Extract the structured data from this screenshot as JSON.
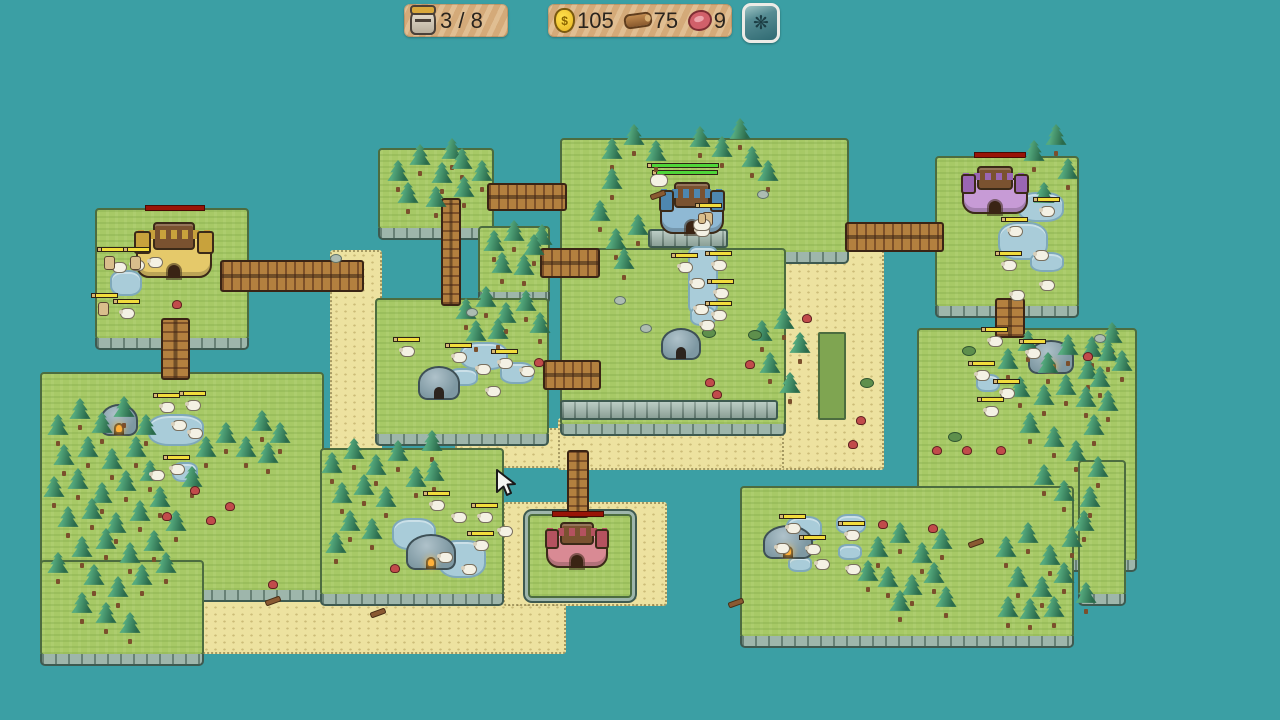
{
  "hud": {
    "units": {
      "icon": "helmet-icon",
      "value": "3 / 8"
    },
    "resources": [
      {
        "icon": "gold-bag-icon",
        "value": "105"
      },
      {
        "icon": "wood-log-icon",
        "value": "75"
      },
      {
        "icon": "meat-icon",
        "value": "9"
      }
    ],
    "settings": {
      "icon": "gear-icon",
      "glyph": "❋"
    }
  },
  "palette": {
    "sea": "#3B9FA4",
    "grass": "#A7C966",
    "sand": "#EDE2A0",
    "water": "#A9CCD9",
    "stone": "#9EB6AB",
    "wood": "#B3803F",
    "tree": "#2B6B4C",
    "health_yellow": "#F2DC3C",
    "health_green": "#4ED639",
    "spawn_red": "#991407",
    "hud_panel": "#D4AA79"
  },
  "cursor": {
    "x": 494,
    "y": 468
  },
  "map": {
    "sands": [
      [
        330,
        250,
        48,
        212
      ],
      [
        200,
        588,
        362,
        62
      ],
      [
        455,
        428,
        208,
        36
      ],
      [
        503,
        502,
        160,
        100
      ],
      [
        775,
        238,
        105,
        228
      ],
      [
        558,
        418,
        222,
        48
      ],
      [
        740,
        588,
        96,
        46
      ]
    ],
    "plots": [
      [
        818,
        332,
        24,
        84
      ]
    ],
    "islands": [
      {
        "n": "top-left-castle-island",
        "r": [
          95,
          208,
          150,
          128
        ]
      },
      {
        "n": "top-tree-island",
        "r": [
          378,
          148,
          112,
          78
        ]
      },
      {
        "n": "small-tree-island",
        "r": [
          478,
          226,
          68,
          64
        ]
      },
      {
        "n": "central-island-north",
        "r": [
          560,
          138,
          285,
          112
        ]
      },
      {
        "n": "central-island-south",
        "r": [
          560,
          248,
          222,
          174
        ]
      },
      {
        "n": "hut-island",
        "r": [
          375,
          298,
          170,
          134
        ]
      },
      {
        "n": "top-right-castle-island",
        "r": [
          935,
          156,
          140,
          148
        ]
      },
      {
        "n": "right-island-main",
        "r": [
          917,
          328,
          216,
          230
        ]
      },
      {
        "n": "right-island-east-step",
        "r": [
          1078,
          460,
          44,
          132
        ]
      },
      {
        "n": "right-island-lower",
        "r": [
          740,
          486,
          330,
          148
        ]
      },
      {
        "n": "left-island-upper",
        "r": [
          40,
          372,
          280,
          216
        ]
      },
      {
        "n": "left-island-lower",
        "r": [
          40,
          560,
          160,
          92
        ]
      },
      {
        "n": "bottom-mid-tree-island",
        "r": [
          320,
          448,
          180,
          144
        ]
      },
      {
        "n": "red-castle-patch",
        "r": [
          528,
          514,
          100,
          80
        ],
        "ring": true
      }
    ],
    "walls": [
      [
        560,
        400,
        214,
        16
      ],
      [
        648,
        229,
        76,
        15
      ]
    ],
    "bridges": [
      {
        "n": "bridge-topleft-east",
        "r": [
          220,
          260,
          140,
          28
        ],
        "dir": "h"
      },
      {
        "n": "bridge-topmid-east",
        "r": [
          487,
          183,
          76,
          24
        ],
        "dir": "h"
      },
      {
        "n": "bridge-central-west-upper",
        "r": [
          540,
          248,
          56,
          26
        ],
        "dir": "h"
      },
      {
        "n": "bridge-central-west-lower",
        "r": [
          543,
          360,
          54,
          26
        ],
        "dir": "h"
      },
      {
        "n": "bridge-central-topright",
        "r": [
          845,
          222,
          95,
          26
        ],
        "dir": "h"
      },
      {
        "n": "bridge-topmid-south",
        "r": [
          441,
          198,
          16,
          104
        ],
        "dir": "v"
      },
      {
        "n": "bridge-topleft-south",
        "r": [
          161,
          318,
          25,
          58
        ],
        "dir": "v"
      },
      {
        "n": "bridge-topright-south",
        "r": [
          995,
          298,
          26,
          36
        ],
        "dir": "v"
      },
      {
        "n": "bridge-red-castle-north",
        "r": [
          567,
          450,
          18,
          64
        ],
        "dir": "v"
      }
    ],
    "ponds": [
      [
        110,
        270,
        28,
        22
      ],
      [
        148,
        414,
        52,
        28
      ],
      [
        172,
        462,
        22,
        16
      ],
      [
        392,
        518,
        40,
        28
      ],
      [
        438,
        540,
        44,
        34
      ],
      [
        460,
        342,
        44,
        24
      ],
      [
        500,
        362,
        30,
        18
      ],
      [
        448,
        368,
        26,
        14
      ],
      [
        688,
        246,
        26,
        64
      ],
      [
        690,
        306,
        22,
        16
      ],
      [
        1018,
        192,
        42,
        26
      ],
      [
        998,
        222,
        46,
        34
      ],
      [
        1030,
        252,
        30,
        16
      ],
      [
        1034,
        342,
        34,
        20
      ],
      [
        976,
        374,
        20,
        14
      ],
      [
        786,
        516,
        32,
        22
      ],
      [
        836,
        514,
        26,
        16
      ],
      [
        838,
        544,
        20,
        12
      ],
      [
        788,
        556,
        20,
        12
      ]
    ],
    "castles": [
      {
        "n": "castle-yellow",
        "r": [
          136,
          222,
          76,
          56
        ],
        "wall": "#E5C96A",
        "accent": "#C8A23C"
      },
      {
        "n": "castle-blue",
        "r": [
          660,
          182,
          64,
          52
        ],
        "wall": "#8FB9D4",
        "accent": "#4E87B0"
      },
      {
        "n": "castle-purple",
        "r": [
          962,
          166,
          66,
          48
        ],
        "wall": "#C79BD6",
        "accent": "#9A66B4"
      },
      {
        "n": "castle-red",
        "r": [
          546,
          522,
          62,
          46
        ],
        "wall": "#D98A94",
        "accent": "#B4525F"
      }
    ],
    "spawn_bars": [
      [
        145,
        205,
        58
      ],
      [
        974,
        152,
        50
      ],
      [
        552,
        511,
        50
      ]
    ],
    "queue_bars": [
      [
        647,
        163,
        72
      ],
      [
        652,
        170,
        66
      ]
    ],
    "huts": [
      {
        "r": [
          418,
          366,
          38,
          30
        ],
        "fire": false
      },
      {
        "r": [
          661,
          328,
          36,
          28
        ],
        "fire": false
      },
      {
        "r": [
          100,
          404,
          34,
          28
        ],
        "fire": true
      },
      {
        "r": [
          406,
          534,
          46,
          32
        ],
        "fire": true
      },
      {
        "r": [
          763,
          525,
          46,
          30
        ],
        "fire": true
      },
      {
        "r": [
          1028,
          340,
          42,
          30
        ],
        "fire": true
      }
    ],
    "trees": [
      [
        398,
        192
      ],
      [
        420,
        176
      ],
      [
        442,
        194
      ],
      [
        462,
        180
      ],
      [
        408,
        214
      ],
      [
        436,
        218
      ],
      [
        464,
        208
      ],
      [
        482,
        192
      ],
      [
        452,
        170
      ],
      [
        494,
        262
      ],
      [
        514,
        252
      ],
      [
        534,
        266
      ],
      [
        502,
        284
      ],
      [
        524,
        286
      ],
      [
        542,
        256
      ],
      [
        612,
        170
      ],
      [
        634,
        156
      ],
      [
        656,
        172
      ],
      [
        612,
        200
      ],
      [
        600,
        232
      ],
      [
        616,
        260
      ],
      [
        638,
        246
      ],
      [
        624,
        280
      ],
      [
        700,
        158
      ],
      [
        722,
        168
      ],
      [
        752,
        178
      ],
      [
        768,
        192
      ],
      [
        740,
        150
      ],
      [
        762,
        352
      ],
      [
        784,
        340
      ],
      [
        800,
        364
      ],
      [
        770,
        384
      ],
      [
        790,
        404
      ],
      [
        466,
        330
      ],
      [
        486,
        318
      ],
      [
        506,
        334
      ],
      [
        526,
        322
      ],
      [
        540,
        344
      ],
      [
        476,
        352
      ],
      [
        498,
        350
      ],
      [
        1034,
        172
      ],
      [
        1056,
        156
      ],
      [
        1068,
        190
      ],
      [
        1044,
        214
      ],
      [
        1008,
        380
      ],
      [
        1028,
        362
      ],
      [
        1048,
        384
      ],
      [
        1068,
        366
      ],
      [
        1088,
        390
      ],
      [
        1108,
        372
      ],
      [
        1020,
        408
      ],
      [
        1044,
        416
      ],
      [
        1066,
        406
      ],
      [
        1092,
        368
      ],
      [
        1112,
        354
      ],
      [
        1122,
        382
      ],
      [
        1100,
        398
      ],
      [
        1086,
        418
      ],
      [
        1108,
        422
      ],
      [
        1094,
        446
      ],
      [
        1030,
        444
      ],
      [
        1054,
        458
      ],
      [
        1076,
        472
      ],
      [
        1098,
        488
      ],
      [
        1044,
        496
      ],
      [
        1064,
        512
      ],
      [
        1090,
        518
      ],
      [
        1084,
        542
      ],
      [
        878,
        568
      ],
      [
        900,
        554
      ],
      [
        922,
        574
      ],
      [
        942,
        560
      ],
      [
        888,
        598
      ],
      [
        912,
        606
      ],
      [
        934,
        594
      ],
      [
        946,
        618
      ],
      [
        900,
        622
      ],
      [
        868,
        592
      ],
      [
        1006,
        568
      ],
      [
        1028,
        554
      ],
      [
        1050,
        576
      ],
      [
        1072,
        558
      ],
      [
        1018,
        598
      ],
      [
        1042,
        608
      ],
      [
        1064,
        594
      ],
      [
        1086,
        614
      ],
      [
        1030,
        630
      ],
      [
        1054,
        628
      ],
      [
        1008,
        628
      ],
      [
        58,
        446
      ],
      [
        80,
        430
      ],
      [
        102,
        444
      ],
      [
        124,
        428
      ],
      [
        146,
        446
      ],
      [
        64,
        476
      ],
      [
        88,
        468
      ],
      [
        112,
        480
      ],
      [
        136,
        468
      ],
      [
        54,
        508
      ],
      [
        78,
        500
      ],
      [
        102,
        514
      ],
      [
        126,
        502
      ],
      [
        150,
        492
      ],
      [
        68,
        538
      ],
      [
        92,
        530
      ],
      [
        116,
        544
      ],
      [
        140,
        532
      ],
      [
        160,
        518
      ],
      [
        82,
        568
      ],
      [
        106,
        560
      ],
      [
        130,
        574
      ],
      [
        154,
        562
      ],
      [
        58,
        584
      ],
      [
        94,
        596
      ],
      [
        118,
        608
      ],
      [
        142,
        596
      ],
      [
        166,
        584
      ],
      [
        106,
        634
      ],
      [
        130,
        644
      ],
      [
        82,
        624
      ],
      [
        176,
        542
      ],
      [
        192,
        498
      ],
      [
        206,
        468
      ],
      [
        226,
        454
      ],
      [
        246,
        468
      ],
      [
        262,
        442
      ],
      [
        280,
        454
      ],
      [
        268,
        474
      ],
      [
        332,
        484
      ],
      [
        354,
        470
      ],
      [
        376,
        486
      ],
      [
        398,
        472
      ],
      [
        342,
        514
      ],
      [
        364,
        506
      ],
      [
        386,
        518
      ],
      [
        350,
        542
      ],
      [
        372,
        550
      ],
      [
        336,
        564
      ],
      [
        416,
        498
      ],
      [
        432,
        462
      ],
      [
        434,
        492
      ]
    ],
    "mushrooms": [
      [
        172,
        300
      ],
      [
        705,
        378
      ],
      [
        745,
        360
      ],
      [
        712,
        390
      ],
      [
        190,
        486
      ],
      [
        225,
        502
      ],
      [
        206,
        516
      ],
      [
        162,
        512
      ],
      [
        878,
        520
      ],
      [
        928,
        524
      ],
      [
        962,
        446
      ],
      [
        996,
        446
      ],
      [
        848,
        440
      ],
      [
        856,
        416
      ],
      [
        932,
        446
      ],
      [
        534,
        358
      ],
      [
        268,
        580
      ],
      [
        390,
        564
      ],
      [
        802,
        314
      ],
      [
        1083,
        352
      ]
    ],
    "rocks": [
      [
        614,
        296
      ],
      [
        640,
        324
      ],
      [
        330,
        254
      ],
      [
        466,
        308
      ],
      [
        1094,
        334
      ],
      [
        757,
        190
      ]
    ],
    "bushes": [
      [
        702,
        328
      ],
      [
        748,
        330
      ],
      [
        962,
        346
      ],
      [
        948,
        432
      ],
      [
        860,
        378
      ]
    ],
    "sticks": [
      [
        265,
        598
      ],
      [
        370,
        610
      ],
      [
        728,
        600
      ],
      [
        968,
        540
      ],
      [
        650,
        192
      ]
    ],
    "sheep": [
      [
        112,
        262,
        0
      ],
      [
        130,
        260,
        0
      ],
      [
        148,
        257,
        0
      ],
      [
        120,
        308,
        1
      ],
      [
        160,
        402,
        1
      ],
      [
        186,
        400,
        1
      ],
      [
        172,
        420,
        0
      ],
      [
        188,
        428,
        0
      ],
      [
        170,
        464,
        1
      ],
      [
        150,
        470,
        0
      ],
      [
        400,
        346,
        1
      ],
      [
        452,
        352,
        1
      ],
      [
        476,
        364,
        0
      ],
      [
        498,
        358,
        1
      ],
      [
        520,
        366,
        0
      ],
      [
        486,
        386,
        0
      ],
      [
        678,
        262,
        1
      ],
      [
        712,
        260,
        1
      ],
      [
        690,
        278,
        0
      ],
      [
        714,
        288,
        1
      ],
      [
        694,
        304,
        0
      ],
      [
        712,
        310,
        1
      ],
      [
        700,
        320,
        0
      ],
      [
        1040,
        206,
        1
      ],
      [
        1008,
        226,
        1
      ],
      [
        1034,
        250,
        0
      ],
      [
        1002,
        260,
        1
      ],
      [
        1040,
        280,
        0
      ],
      [
        1010,
        290,
        0
      ],
      [
        975,
        370,
        1
      ],
      [
        988,
        336,
        1
      ],
      [
        1000,
        388,
        1
      ],
      [
        984,
        406,
        1
      ],
      [
        1026,
        348,
        1
      ],
      [
        430,
        500,
        1
      ],
      [
        452,
        512,
        0
      ],
      [
        478,
        512,
        1
      ],
      [
        498,
        526,
        0
      ],
      [
        474,
        540,
        1
      ],
      [
        438,
        552,
        0
      ],
      [
        462,
        564,
        0
      ],
      [
        845,
        530,
        1
      ],
      [
        775,
        543,
        0
      ],
      [
        806,
        544,
        1
      ],
      [
        815,
        559,
        0
      ],
      [
        846,
        564,
        0
      ],
      [
        786,
        523,
        1
      ],
      [
        695,
        226,
        0
      ]
    ],
    "units": [
      [
        104,
        256
      ],
      [
        130,
        256
      ],
      [
        98,
        302
      ],
      [
        702,
        212
      ]
    ],
    "horse": [
      650,
      174
    ],
    "rider": [
      693,
      211
    ]
  }
}
